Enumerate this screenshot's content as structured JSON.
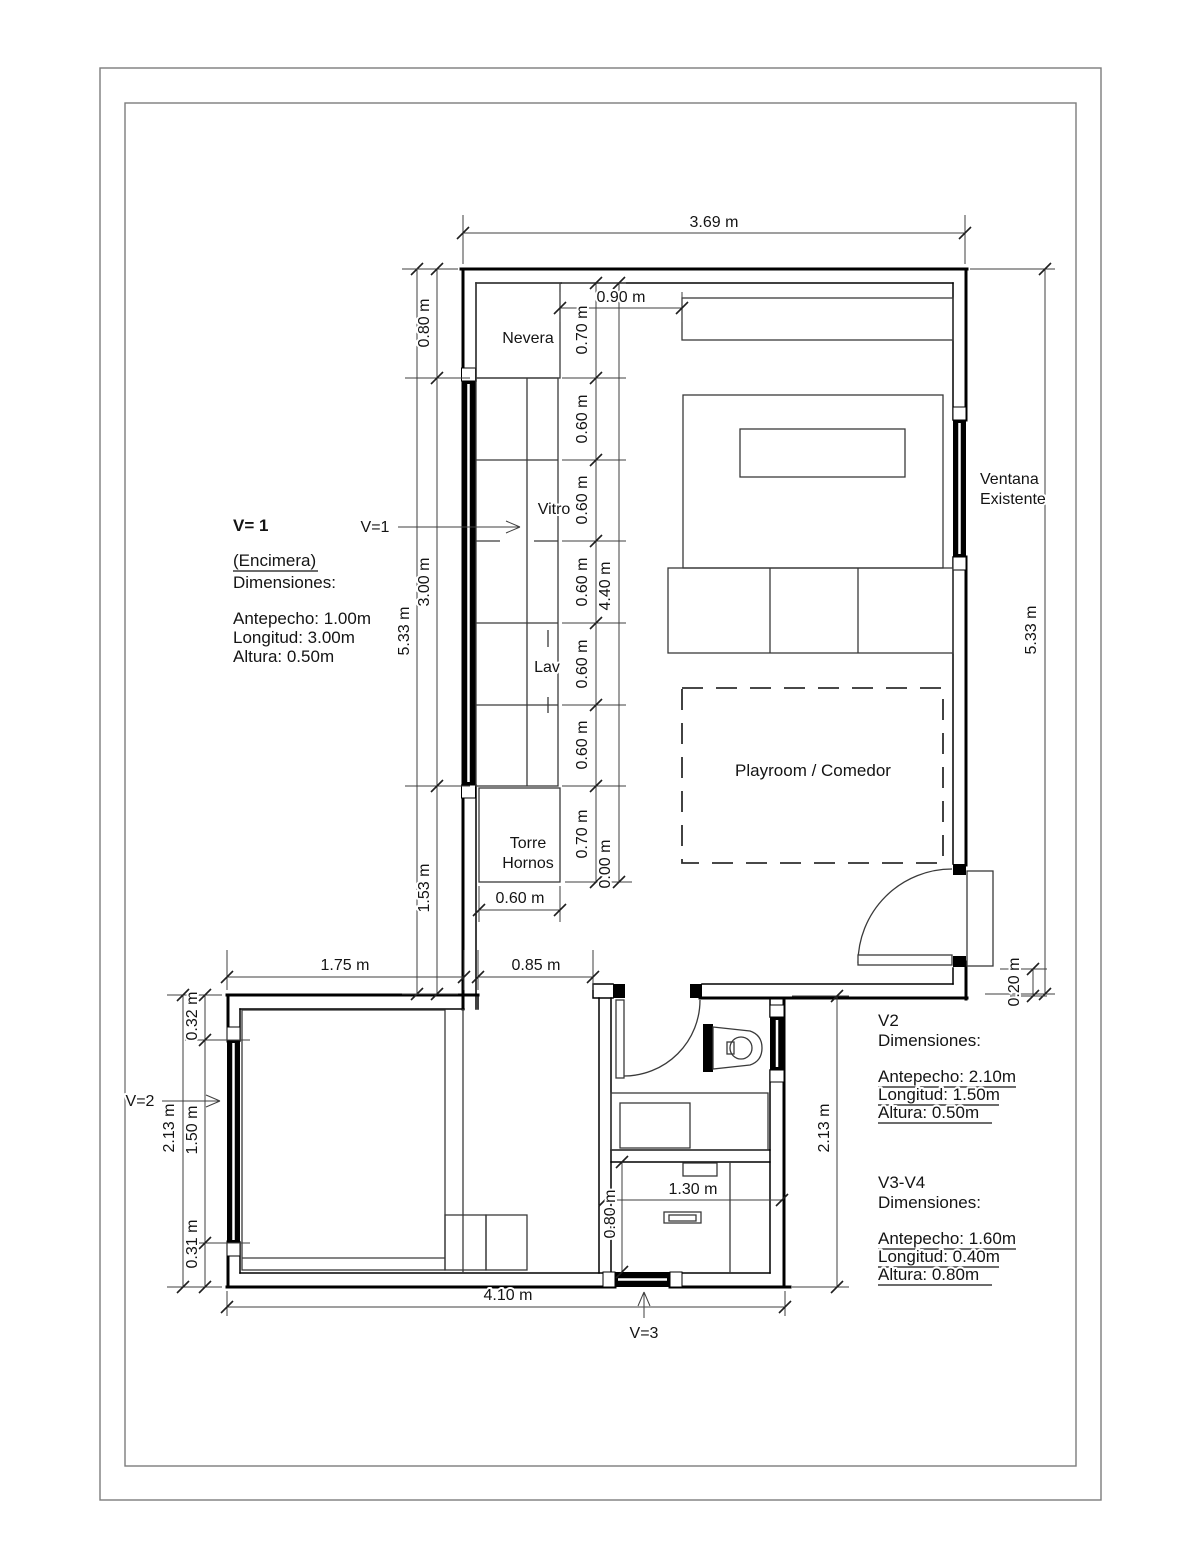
{
  "sheet": {
    "background": "#ffffff",
    "wall_color": "#000000",
    "border_color": "#7c7c7c"
  },
  "rooms": {
    "playroom": "Playroom / Comedor"
  },
  "fixtures": {
    "fridge": "Nevera",
    "cooktop": "Vitro",
    "sink": "Lav",
    "oven_line1": "Torre",
    "oven_line2": "Hornos"
  },
  "markers": {
    "v1": "V=1",
    "v2": "V=2",
    "v3": "V=3"
  },
  "annotations": {
    "existing_window_line1": "Ventana",
    "existing_window_line2": "Existente",
    "v1_note": {
      "heading": "V= 1",
      "subject": "(Encimera)",
      "dims_label": "Dimensiones:",
      "antepecho": "Antepecho: 1.00m",
      "longitud": "Longitud: 3.00m",
      "altura": "Altura: 0.50m"
    },
    "v2_note": {
      "heading": "V2",
      "dims_label": "Dimensiones:",
      "antepecho": "Antepecho: 2.10m",
      "longitud": "Longitud: 1.50m",
      "altura": "Altura: 0.50m"
    },
    "v3_v4_note": {
      "heading": "V3-V4",
      "dims_label": "Dimensiones:",
      "antepecho": "Antepecho: 1.60m",
      "longitud": "Longitud: 0.40m",
      "altura": "Altura: 0.80m"
    }
  },
  "dimensions": {
    "top_width": "3.69 m",
    "left_overall": "5.33 m",
    "left_chain": [
      "0.80 m",
      "3.00 m",
      "1.53 m"
    ],
    "counter_offset_top": "0.90 m",
    "counter_chain": [
      "0.70 m",
      "0.60 m",
      "0.60 m",
      "0.60 m",
      "0.60 m",
      "0.60 m",
      "0.70 m"
    ],
    "counter_zero": "0.00 m",
    "counter_total": "4.40 m",
    "oven_width": "0.60 m",
    "right_overall": "5.33 m",
    "door_side_offset": "0.20 m",
    "bedroom_top_width": "1.75 m",
    "passage_width": "0.85 m",
    "bedroom_window_chain": [
      "0.32 m",
      "1.50 m",
      "0.31 m"
    ],
    "bedroom_height": "2.13 m",
    "wing_right_height": "2.13 m",
    "desk_width": "1.30 m",
    "desk_depth": "0.80 m",
    "wing_bottom_width": "4.10 m"
  }
}
